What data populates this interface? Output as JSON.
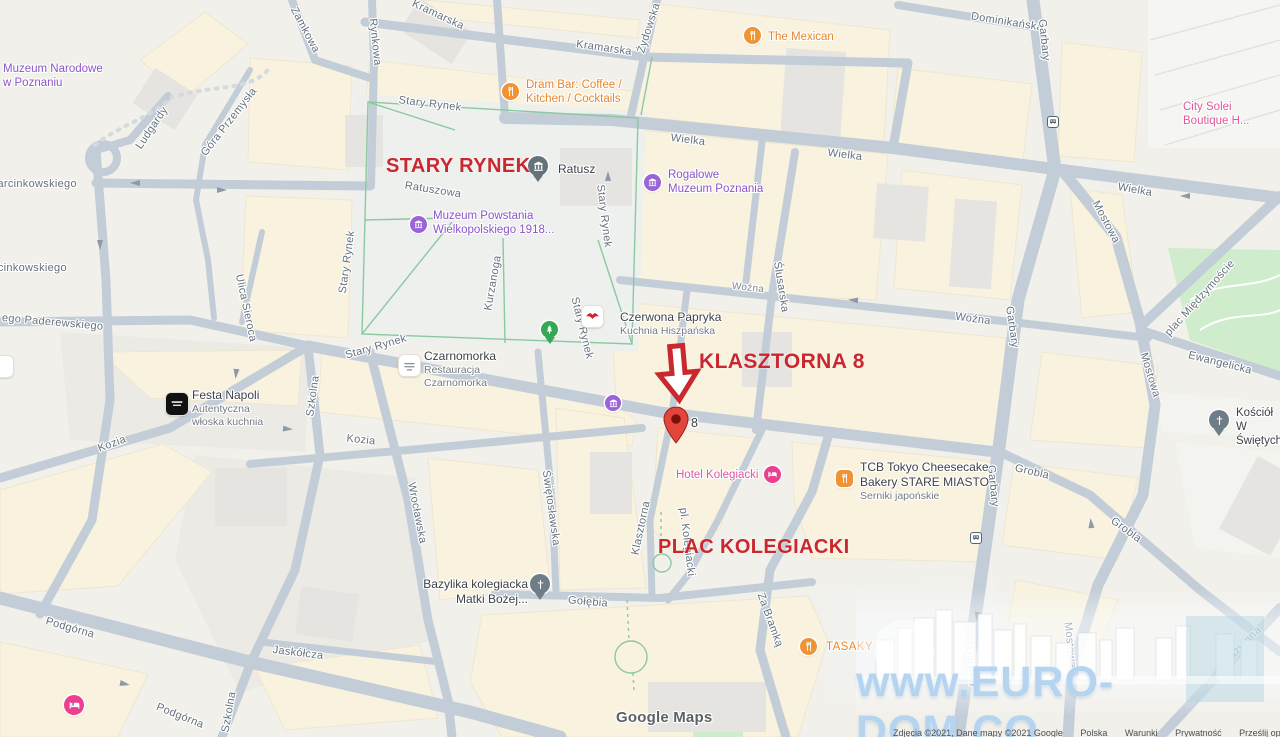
{
  "overlay": {
    "stary_rynek": "STARY RYNEK",
    "klasztorna_8": "KLASZTORNA 8",
    "plac_kolegiacki": "PLAC KOLEGIACKI",
    "pin_house_number": "8",
    "accent_red": "#c9282e"
  },
  "streets": {
    "kramarska": "Kramarska",
    "zamkowa": "Zamkowa",
    "rynkowa": "Rynkowa",
    "zydowska": "Żydowska",
    "dominikanska": "Dominikańska",
    "garbary": "Garbary",
    "wielka": "Wielka",
    "mostowa": "Mostowa",
    "plac_miedzymoscie": "plac Międzymoście",
    "ewangelicka": "Ewangelicka",
    "lazienna": "Łazienna",
    "grobla": "Grobla",
    "wozna": "Woźna",
    "slusarska": "Ślusarska",
    "klasztorna": "Klasztorna",
    "pl_kolegiacki": "pl. Kolegiacki",
    "za_bramka": "Za Bramką",
    "golebia": "Gołębia",
    "swietoslawska": "Świętosławska",
    "wroclawska": "Wrocławska",
    "kozia": "Kozia",
    "szkolna": "Szkolna",
    "podgorna": "Podgórna",
    "jaskolcza": "Jaskółcza",
    "ulica_sieroca": "Ulica Sieroca",
    "gora_przemysla": "Góra Przemysła",
    "ludgardy": "Ludgardy",
    "marcinkowskiego": "Marcinkowskiego",
    "paderewskiego": "ego Paderewskiego",
    "stary_rynek": "Stary Rynek",
    "ratuszowa": "Ratuszowa",
    "kurzanoga": "Kurzanoga"
  },
  "pois": {
    "muzeum_narodowe": {
      "label": "Muzeum Narodowe\nw Poznaniu",
      "type": "museum"
    },
    "the_mexican": {
      "label": "The Mexican",
      "type": "restaurant"
    },
    "dram_bar": {
      "label": "Dram Bar: Coffee /\nKitchen / Cocktails",
      "type": "restaurant"
    },
    "ratusz": {
      "label": "Ratusz",
      "type": "landmark"
    },
    "rogalowe_muzeum": {
      "label": "Rogalowe\nMuzeum Poznania",
      "type": "museum"
    },
    "muzeum_powstania": {
      "label": "Muzeum Powstania\nWielkopolskiego 1918...",
      "type": "museum"
    },
    "czerwona_papryka": {
      "label": "Czerwona Papryka",
      "sublabel": "Kuchnia Hiszpańska",
      "type": "restaurant"
    },
    "czarnomorka": {
      "label": "Czarnomorka",
      "sublabel": "Restauracja\nCzarnomorka",
      "type": "restaurant"
    },
    "festa_napoli": {
      "label": "Festa Napoli",
      "sublabel": "Autentyczna\nwłoska kuchnia",
      "type": "restaurant"
    },
    "hotel_kolegiacki": {
      "label": "Hotel Kolegiacki",
      "type": "hotel"
    },
    "tcb_tokyo": {
      "label": "TCB Tokyo Cheesecake\nBakery STARE MIASTO",
      "sublabel": "Serniki japońskie",
      "type": "bakery"
    },
    "bazylika": {
      "label": "Bazylika kolegiacka\nMatki Bożej...",
      "type": "church"
    },
    "kosciol": {
      "label": "Kościół W\nŚwiętych",
      "type": "church"
    },
    "tasaky": {
      "label": "TASAKY",
      "type": "restaurant"
    },
    "city_solei": {
      "label": "City Solei Boutique H...",
      "type": "hotel"
    }
  },
  "watermark": {
    "text": "www.EURO-DOM.CO"
  },
  "branding": {
    "google_logo": "Google Maps"
  },
  "attribution": {
    "copyright": "Zdjęcia ©2021, Dane mapy ©2021 Google",
    "links": [
      "Polska",
      "Warunki",
      "Prywatność",
      "Prześlij opinię o produkcie"
    ]
  },
  "colors": {
    "road": "#c3cdd7",
    "block": "#f8f2df",
    "park": "#cfeccd",
    "poi_orange": "#f09334",
    "poi_purple": "#9a63d8",
    "poi_pink": "#ec3f8f",
    "poi_gray_pin": "#64727c",
    "overlay_red": "#c9282e",
    "street_label": "#66717c"
  }
}
